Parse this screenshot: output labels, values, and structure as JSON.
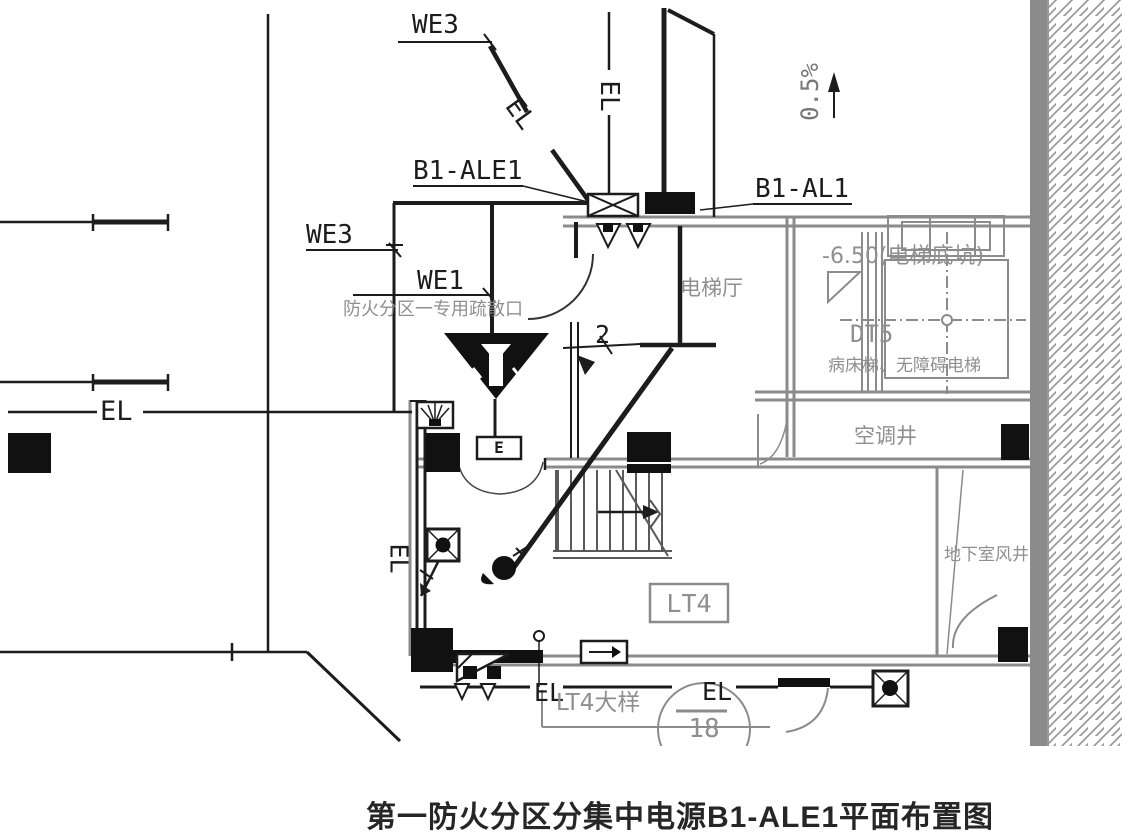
{
  "title": "第一防火分区分集中电源B1-ALE1平面布置图",
  "labels": {
    "we3_top": "WE3",
    "we3_left": "WE3",
    "we1": "WE1",
    "b1_ale1": "B1-ALE1",
    "b1_al1": "B1-AL1",
    "slope": "0.5%",
    "wire_count": "2",
    "exit_e": "E",
    "el_diagonal": "EL",
    "el_shaft": "EL",
    "el_left": "EL",
    "el_wall": "EL",
    "el_bottom_left": "EL",
    "el_bottom_right": "EL"
  },
  "rooms": {
    "fire_zone_note": "防火分区一专用疏散口",
    "elevator_hall": "电梯厅",
    "pit_level": "-6.50(电梯底坑)",
    "elevator_id": "DT5",
    "elevator_names": "病床梯、无障碍电梯",
    "ac_shaft": "空调井",
    "basement_air_shaft": "地下室风井",
    "stair_id": "LT4",
    "stair_detail_label": "LT4大样",
    "detail_sheet_number": "18"
  },
  "colors": {
    "line_black": "#1c1c1c",
    "wall_gray": "#8b8b8b",
    "text_gray": "#8f8f8f",
    "hatch_gray": "#9a9a9a",
    "title_color": "#262626"
  }
}
